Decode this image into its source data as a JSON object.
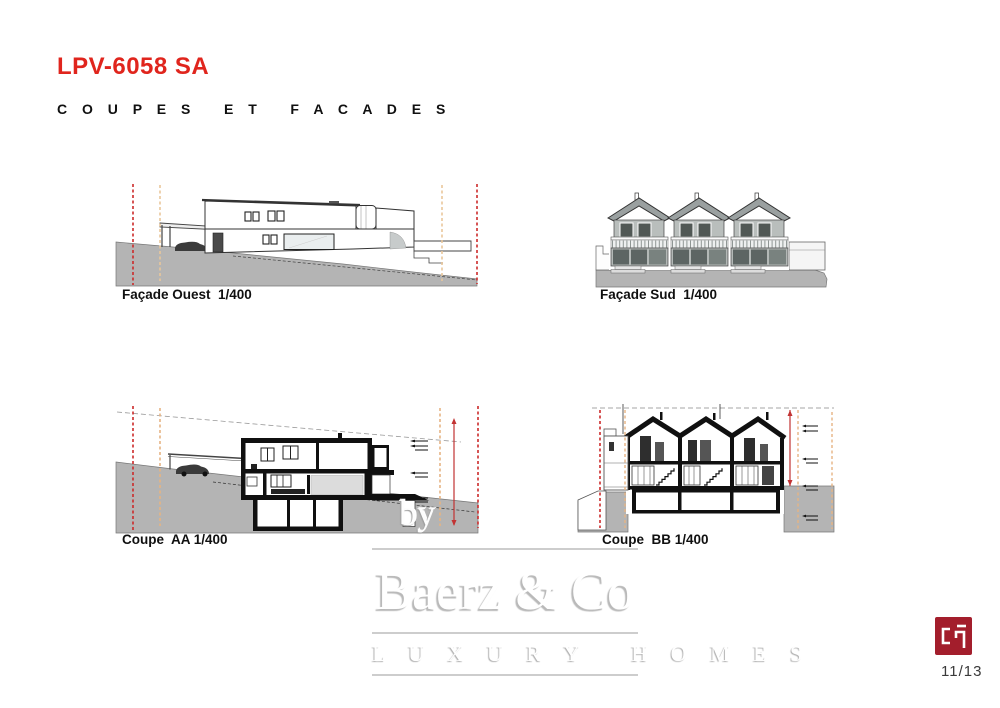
{
  "page": {
    "title": "LPV-6058 SA",
    "subtitle": "C O U P E S   E T   F A C A D E S",
    "page_number": "11/13"
  },
  "drawings": [
    {
      "id": "facade-ouest",
      "caption": "Façade Ouest  1/400",
      "scale": "1/400"
    },
    {
      "id": "facade-sud",
      "caption": "Façade Sud  1/400",
      "scale": "1/400"
    },
    {
      "id": "coupe-aa",
      "caption": "Coupe  AA 1/400",
      "scale": "1/400"
    },
    {
      "id": "coupe-bb",
      "caption": "Coupe  BB 1/400",
      "scale": "1/400"
    }
  ],
  "watermark": {
    "prefix": "by",
    "name": "Baerz & Co",
    "tagline": "L U X U R Y   H O M E S"
  },
  "icons": {
    "logo": "cp-monogram"
  },
  "colors": {
    "title_red": "#e0251d",
    "logo_red": "#a31e2c",
    "terrain_gray": "#b4b4b4",
    "facade_gray": "#b3b8b6",
    "roof_gray": "#9aa0a0",
    "guide_red": "#cc2a2a",
    "guide_orange": "#e6c292"
  }
}
